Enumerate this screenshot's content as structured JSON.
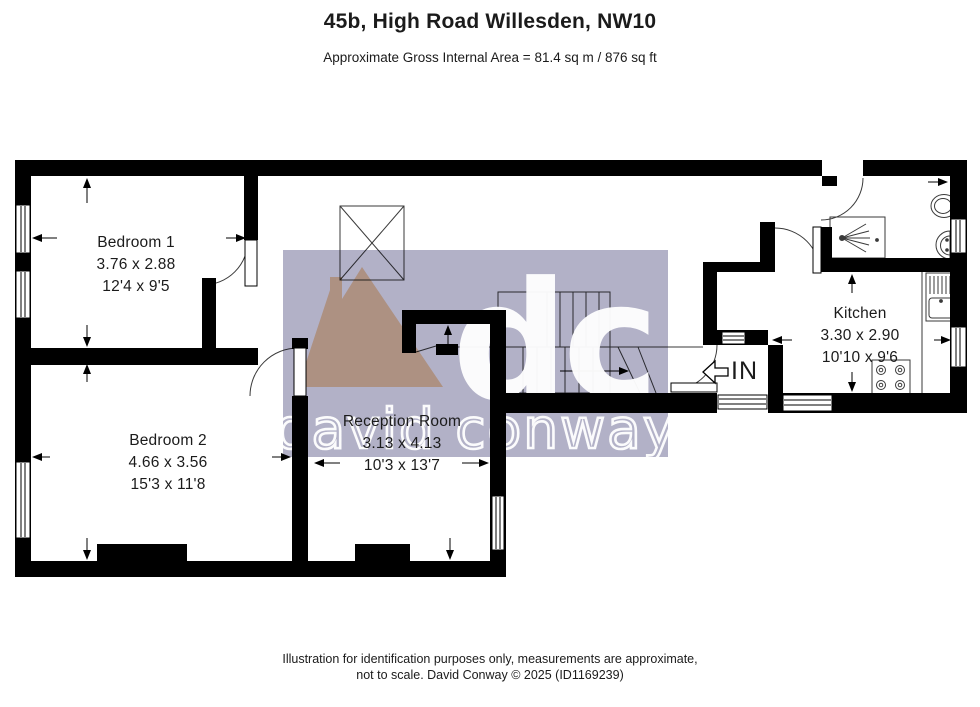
{
  "header": {
    "title": "45b, High Road Willesden, NW10",
    "subtitle": "Approximate Gross Internal Area = 81.4 sq m / 876 sq ft"
  },
  "rooms": {
    "bedroom1": {
      "name": "Bedroom 1",
      "metric": "3.76 x 2.88",
      "imperial": "12'4 x 9'5"
    },
    "bedroom2": {
      "name": "Bedroom 2",
      "metric": "4.66 x 3.56",
      "imperial": "15'3 x 11'8"
    },
    "reception": {
      "name": "Reception Room",
      "metric": "3.13 x 4.13",
      "imperial": "10'3 x 13'7"
    },
    "kitchen": {
      "name": "Kitchen",
      "metric": "3.30 x 2.90",
      "imperial": "10'10 x 9'6"
    }
  },
  "entrance": {
    "label": "IN"
  },
  "watermark": {
    "initials": "dc",
    "name": "david conway",
    "lavender": "#b2b1c7",
    "peach": "#f8d1a6"
  },
  "footer": {
    "line1": "Illustration for identification purposes only, measurements are approximate,",
    "line2": "not to scale. David Conway © 2025 (ID1169239)"
  }
}
